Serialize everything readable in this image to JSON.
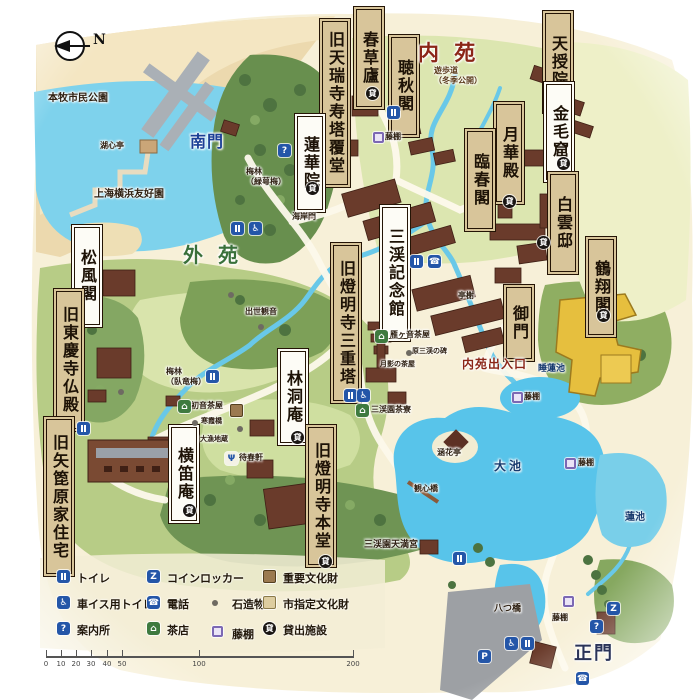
{
  "title": "三渓園 園内マップ",
  "compass": {
    "label": "N"
  },
  "colors": {
    "water": "#58c4ea",
    "inner_garden_text": "#8b2517",
    "outer_garden_text": "#39703a",
    "south_gate_text": "#1b3f96",
    "main_gate_text": "#2a3358",
    "box_beige": "#d8c59a",
    "box_white": "#fdfcf6",
    "important_property": "#9b7a50",
    "city_property": "#ddcda0",
    "wisteria": "#7c68b4",
    "gold_building": "#e6bf3e"
  },
  "map": {
    "boxes": [
      {
        "text": "春草廬",
        "style": "beige",
        "x": 356,
        "y": 9,
        "h": 86
      },
      {
        "text": "旧天瑞寺寿塔覆堂",
        "style": "beige",
        "x": 322,
        "y": 21,
        "h": 152
      },
      {
        "text": "聴秋閣",
        "style": "beige",
        "x": 391,
        "y": 37,
        "h": 86
      },
      {
        "text": "天授院",
        "style": "beige",
        "x": 545,
        "y": 13,
        "h": 86
      },
      {
        "text": "金毛窟",
        "style": "white",
        "x": 546,
        "y": 84,
        "h": 84
      },
      {
        "text": "月華殿",
        "style": "beige",
        "x": 496,
        "y": 104,
        "h": 86
      },
      {
        "text": "臨春閣",
        "style": "beige",
        "x": 467,
        "y": 131,
        "h": 86
      },
      {
        "text": "白雲邸",
        "style": "beige",
        "x": 550,
        "y": 174,
        "h": 86
      },
      {
        "text": "鶴翔閣",
        "style": "beige",
        "x": 588,
        "y": 239,
        "h": 84
      },
      {
        "text": "蓮華院",
        "style": "white",
        "x": 297,
        "y": 116,
        "h": 82
      },
      {
        "text": "御門",
        "style": "beige",
        "x": 506,
        "y": 287,
        "h": 60
      },
      {
        "text": "三渓記念館",
        "style": "white",
        "x": 382,
        "y": 207,
        "h": 120
      },
      {
        "text": "旧燈明寺三重塔",
        "style": "beige",
        "x": 333,
        "y": 245,
        "h": 144
      },
      {
        "text": "松風閣",
        "style": "white",
        "x": 74,
        "y": 227,
        "h": 86
      },
      {
        "text": "旧東慶寺仏殿",
        "style": "beige",
        "x": 56,
        "y": 291,
        "h": 126
      },
      {
        "text": "旧矢箆原家住宅",
        "style": "beige",
        "x": 46,
        "y": 419,
        "h": 143
      },
      {
        "text": "横笛庵",
        "style": "white",
        "x": 171,
        "y": 427,
        "h": 82
      },
      {
        "text": "林洞庵",
        "style": "white",
        "x": 280,
        "y": 351,
        "h": 80
      },
      {
        "text": "旧燈明寺本堂",
        "style": "beige",
        "x": 308,
        "y": 427,
        "h": 126
      }
    ],
    "texts": [
      {
        "text": "内 苑",
        "x": 418,
        "y": 40,
        "s": 21,
        "c": "#8b2517",
        "ls": 4
      },
      {
        "text": "外 苑",
        "x": 183,
        "y": 243,
        "s": 20,
        "c": "#39703a",
        "ls": 4
      },
      {
        "text": "南門",
        "x": 190,
        "y": 132,
        "s": 16,
        "c": "#1b3f96",
        "ls": 1
      },
      {
        "text": "正門",
        "x": 574,
        "y": 643,
        "s": 18,
        "c": "#2a3358",
        "ls": 2
      },
      {
        "text": "本牧市民公園",
        "x": 48,
        "y": 93,
        "s": 10,
        "c": "#2e2012"
      },
      {
        "text": "上海横浜友好園",
        "x": 94,
        "y": 189,
        "s": 10,
        "c": "#2e2012"
      },
      {
        "text": "湖心亭",
        "x": 100,
        "y": 140,
        "s": 8,
        "c": "#2e2012"
      },
      {
        "text": "梅林\n（緑萼梅）",
        "x": 246,
        "y": 166,
        "s": 8,
        "c": "#2e2012"
      },
      {
        "text": "海岸門",
        "x": 292,
        "y": 211,
        "s": 8,
        "c": "#2e2012"
      },
      {
        "text": "遊歩道\n（冬季公開）",
        "x": 434,
        "y": 65,
        "s": 8,
        "c": "#5a3a1a"
      },
      {
        "text": "藤棚",
        "x": 385,
        "y": 131,
        "s": 8,
        "c": "#2e2012"
      },
      {
        "text": "亭榭",
        "x": 458,
        "y": 290,
        "s": 8,
        "c": "#2e2012"
      },
      {
        "text": "出世観音",
        "x": 245,
        "y": 306,
        "s": 8,
        "c": "#2e2012"
      },
      {
        "text": "雁ヶ音茶屋",
        "x": 390,
        "y": 329,
        "s": 8,
        "c": "#2e2012"
      },
      {
        "text": "原三渓の碑",
        "x": 412,
        "y": 347,
        "s": 7,
        "c": "#2e2012"
      },
      {
        "text": "月影の茶屋",
        "x": 380,
        "y": 360,
        "s": 7,
        "c": "#2e2012"
      },
      {
        "text": "梅林\n（臥竜梅）",
        "x": 166,
        "y": 366,
        "s": 8,
        "c": "#2e2012"
      },
      {
        "text": "初音茶屋",
        "x": 191,
        "y": 400,
        "s": 8,
        "c": "#2e2012"
      },
      {
        "text": "寒霞橋",
        "x": 201,
        "y": 417,
        "s": 7,
        "c": "#2e2012"
      },
      {
        "text": "大漁地蔵",
        "x": 200,
        "y": 435,
        "s": 7,
        "c": "#2e2012"
      },
      {
        "text": "待春軒",
        "x": 239,
        "y": 452,
        "s": 8,
        "c": "#2e2012"
      },
      {
        "text": "三渓園茶寮",
        "x": 371,
        "y": 404,
        "s": 8,
        "c": "#2e2012"
      },
      {
        "text": "内苑出入口",
        "x": 462,
        "y": 357,
        "s": 12,
        "c": "#8b2517",
        "ls": 1
      },
      {
        "text": "睡蓮池",
        "x": 538,
        "y": 364,
        "s": 9,
        "c": "#173a6e"
      },
      {
        "text": "藤棚",
        "x": 524,
        "y": 391,
        "s": 8,
        "c": "#2e2012"
      },
      {
        "text": "大池",
        "x": 494,
        "y": 459,
        "s": 12,
        "c": "#173a6e",
        "ls": 3
      },
      {
        "text": "蓮池",
        "x": 625,
        "y": 512,
        "s": 10,
        "c": "#173a6e"
      },
      {
        "text": "藤棚",
        "x": 578,
        "y": 457,
        "s": 8,
        "c": "#2e2012"
      },
      {
        "text": "観心橋",
        "x": 414,
        "y": 483,
        "s": 8,
        "c": "#2e2012"
      },
      {
        "text": "涵花亭",
        "x": 437,
        "y": 447,
        "s": 8,
        "c": "#2e2012"
      },
      {
        "text": "三渓園天満宮",
        "x": 364,
        "y": 540,
        "s": 9,
        "c": "#2e2012"
      },
      {
        "text": "八つ橋",
        "x": 494,
        "y": 604,
        "s": 9,
        "c": "#2e2012"
      },
      {
        "text": "藤棚",
        "x": 552,
        "y": 612,
        "s": 8,
        "c": "#2e2012"
      }
    ],
    "icons": [
      {
        "t": "toilet",
        "x": 387,
        "y": 106
      },
      {
        "t": "toilet",
        "x": 231,
        "y": 222
      },
      {
        "t": "toilet",
        "x": 410,
        "y": 255
      },
      {
        "t": "toilet",
        "x": 206,
        "y": 370
      },
      {
        "t": "toilet",
        "x": 344,
        "y": 389
      },
      {
        "t": "toilet",
        "x": 77,
        "y": 422
      },
      {
        "t": "toilet",
        "x": 453,
        "y": 552
      },
      {
        "t": "toilet",
        "x": 521,
        "y": 637
      },
      {
        "t": "wheelchair",
        "x": 249,
        "y": 222
      },
      {
        "t": "wheelchair",
        "x": 357,
        "y": 389
      },
      {
        "t": "wheelchair",
        "x": 505,
        "y": 637
      },
      {
        "t": "info",
        "x": 278,
        "y": 144
      },
      {
        "t": "info",
        "x": 590,
        "y": 620
      },
      {
        "t": "locker",
        "x": 607,
        "y": 602
      },
      {
        "t": "phone",
        "x": 428,
        "y": 255
      },
      {
        "t": "phone",
        "x": 576,
        "y": 672
      },
      {
        "t": "parking",
        "x": 478,
        "y": 650
      },
      {
        "t": "rental",
        "x": 366,
        "y": 87
      },
      {
        "t": "rental",
        "x": 306,
        "y": 182
      },
      {
        "t": "rental",
        "x": 557,
        "y": 157
      },
      {
        "t": "rental",
        "x": 503,
        "y": 195
      },
      {
        "t": "rental",
        "x": 537,
        "y": 236
      },
      {
        "t": "rental",
        "x": 597,
        "y": 309
      },
      {
        "t": "rental",
        "x": 291,
        "y": 431
      },
      {
        "t": "rental",
        "x": 183,
        "y": 504
      },
      {
        "t": "rental",
        "x": 319,
        "y": 555
      },
      {
        "t": "tea",
        "x": 178,
        "y": 400
      },
      {
        "t": "tea",
        "x": 375,
        "y": 330
      },
      {
        "t": "tea",
        "x": 356,
        "y": 404
      },
      {
        "t": "fork",
        "x": 225,
        "y": 452
      },
      {
        "t": "wisteria",
        "x": 373,
        "y": 132
      },
      {
        "t": "wisteria",
        "x": 512,
        "y": 392
      },
      {
        "t": "wisteria",
        "x": 565,
        "y": 458
      },
      {
        "t": "wisteria",
        "x": 563,
        "y": 596
      },
      {
        "t": "icp",
        "x": 230,
        "y": 404
      },
      {
        "t": "stone",
        "x": 228,
        "y": 292
      },
      {
        "t": "stone",
        "x": 258,
        "y": 324
      },
      {
        "t": "stone",
        "x": 118,
        "y": 389
      },
      {
        "t": "stone",
        "x": 406,
        "y": 350
      },
      {
        "t": "stone",
        "x": 237,
        "y": 426
      },
      {
        "t": "stone",
        "x": 192,
        "y": 420
      }
    ]
  },
  "icon_glyphs": {
    "toilet": "",
    "wheelchair": "♿",
    "info": "?",
    "locker": "Z",
    "phone": "☎",
    "parking": "P",
    "tea": "⌂",
    "fork": "Ψ",
    "rental": "貸",
    "stone": "",
    "wisteria": "",
    "icp": "",
    "ccp": ""
  },
  "legend": {
    "items": [
      {
        "icon": "toilet",
        "label": "トイレ",
        "x": 57,
        "y": 570
      },
      {
        "icon": "locker",
        "label": "コインロッカー",
        "x": 147,
        "y": 570
      },
      {
        "icon": "icp",
        "label": "重要文化財",
        "x": 263,
        "y": 570
      },
      {
        "icon": "wheelchair",
        "label": "車イス用トイレ",
        "x": 57,
        "y": 596
      },
      {
        "icon": "phone",
        "label": "電話",
        "x": 147,
        "y": 596
      },
      {
        "icon": "stone",
        "label": "石造物",
        "x": 212,
        "y": 600
      },
      {
        "icon": "ccp",
        "label": "市指定文化財",
        "x": 263,
        "y": 596
      },
      {
        "icon": "info",
        "label": "案内所",
        "x": 57,
        "y": 622
      },
      {
        "icon": "tea",
        "label": "茶店",
        "x": 147,
        "y": 622
      },
      {
        "icon": "wisteria",
        "label": "藤棚",
        "x": 212,
        "y": 626
      },
      {
        "icon": "rental",
        "label": "貸出施設",
        "x": 263,
        "y": 622
      }
    ]
  },
  "scalebar": {
    "x": 46,
    "y": 648,
    "length": 308,
    "ticks": [
      {
        "label": "0",
        "px": 0
      },
      {
        "label": "10",
        "px": 15
      },
      {
        "label": "20",
        "px": 30
      },
      {
        "label": "30",
        "px": 45
      },
      {
        "label": "40",
        "px": 61
      },
      {
        "label": "50",
        "px": 76
      },
      {
        "label": "100",
        "px": 153
      },
      {
        "label": "200",
        "px": 307
      }
    ]
  }
}
